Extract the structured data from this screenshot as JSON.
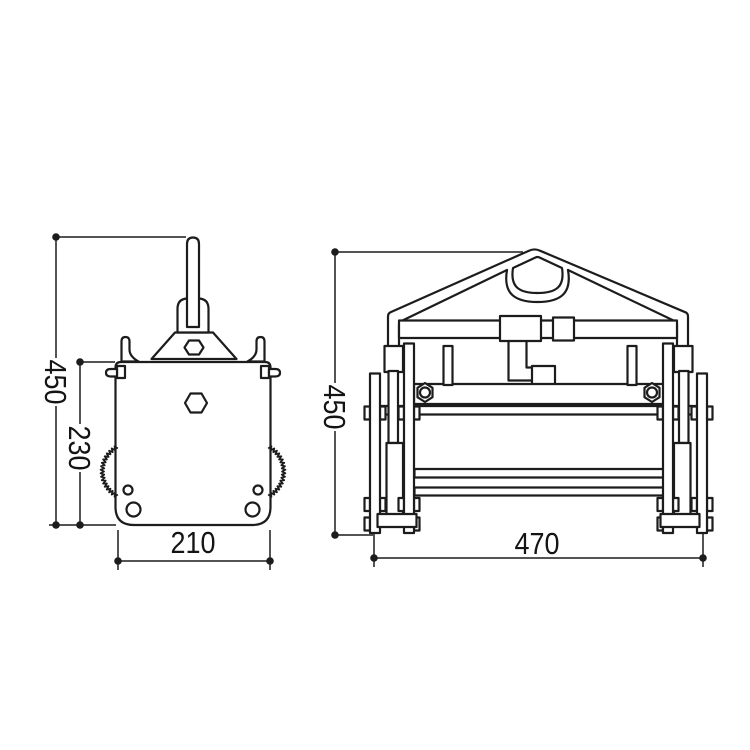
{
  "page": {
    "background": "#ffffff"
  },
  "drawing": {
    "line_color": "#1c1c1c",
    "side_view": {
      "overall_height": "450",
      "body_height": "230",
      "body_width": "210"
    },
    "front_view": {
      "overall_height": "450",
      "overall_width": "470"
    }
  }
}
